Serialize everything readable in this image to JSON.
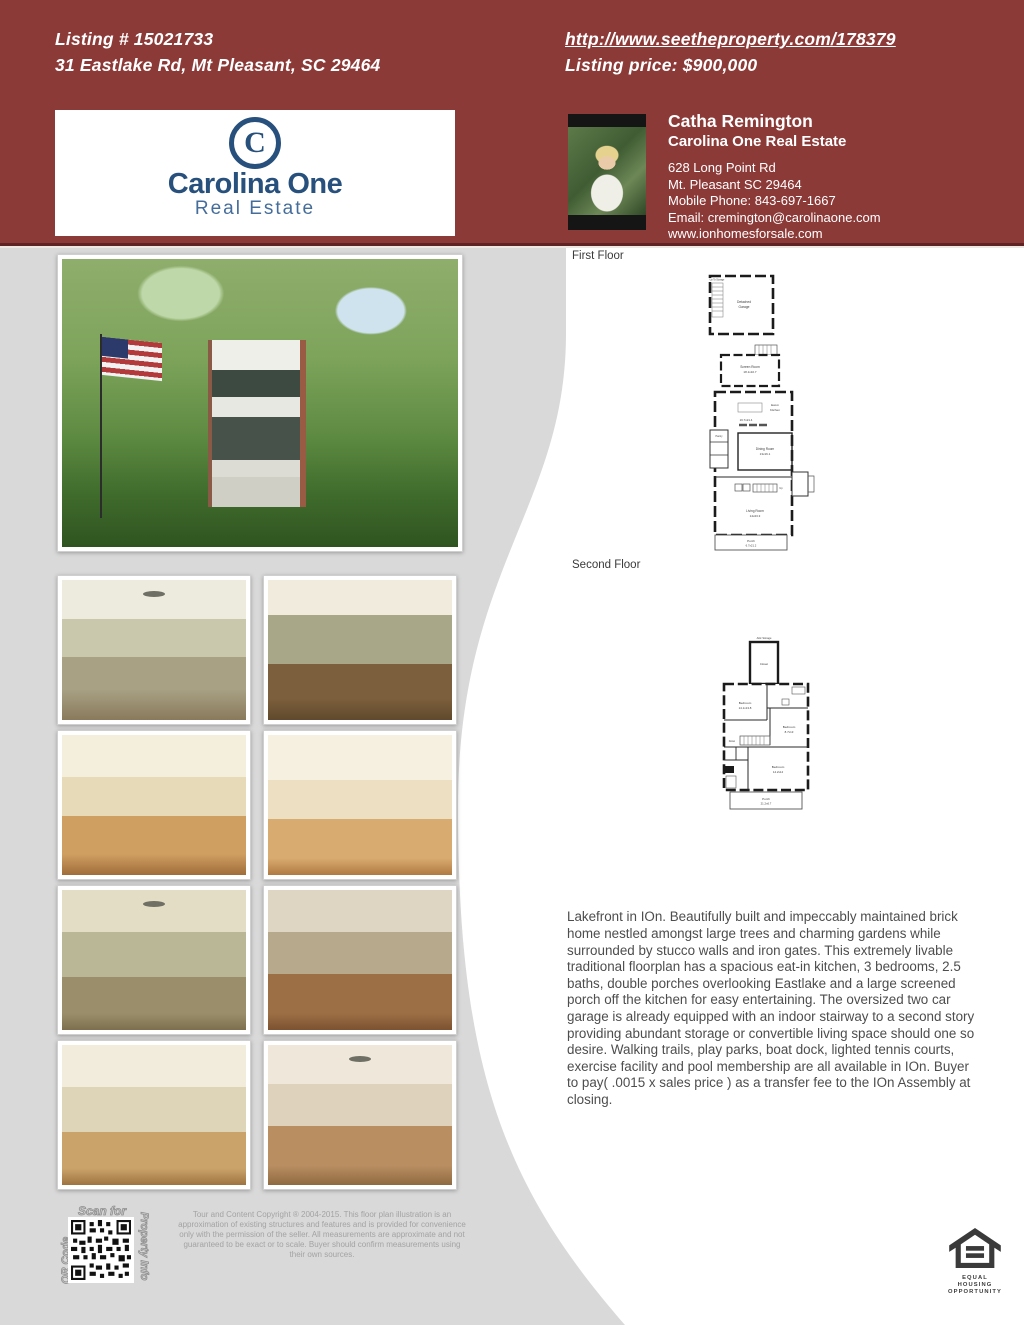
{
  "colors": {
    "maroon_header": "#8c3a38",
    "header_rule": "#5e2423",
    "logo_navy": "#27507c",
    "page_gray": "#d9d9d9",
    "panel_white": "#ffffff",
    "text_gray": "#4d4d4d"
  },
  "header": {
    "listing_number": "Listing # 15021733",
    "address": "31 Eastlake Rd, Mt Pleasant, SC 29464",
    "tour_url": "http://www.seetheproperty.com/178379",
    "price_label": "Listing price: $900,000"
  },
  "brokerage": {
    "monogram": "C",
    "name": "Carolina One",
    "subtitle": "Real Estate"
  },
  "agent": {
    "name": "Catha Remington",
    "company": "Carolina One Real Estate",
    "address_line1": "628 Long Point Rd",
    "address_line2": "Mt. Pleasant SC 29464",
    "phone": "Mobile Phone: 843-697-1667",
    "email": "Email: cremington@carolinaone.com",
    "website": "www.ionhomesforsale.com"
  },
  "photos": {
    "main": "front exterior of brick home with double porches, large trees and American flag",
    "grid": [
      "living room with fireplace and ceiling fan",
      "dining room with floral wallpaper and chandelier",
      "kitchen with wood-top island",
      "kitchen with white cabinets and island",
      "bedroom with ceiling fan and French doors",
      "sitting room with sofa and artwork",
      "home office with bookshelves and lamp",
      "bedroom with four-poster canopy bed"
    ]
  },
  "floorplans": {
    "first_floor": {
      "label": "First Floor",
      "garage": {
        "name_line1": "Detached",
        "name_line2": "Garage",
        "stair_note": "Up To Storage"
      },
      "screen_room": {
        "name": "Screen Room",
        "dim": "18.1x10.7"
      },
      "kitchen": {
        "name_line1": "Eat-in",
        "name_line2": "Kitchen",
        "dim": "16.7x21.4"
      },
      "dining_room": {
        "name": "Dining Room",
        "dim": "13x16.1"
      },
      "pantry": {
        "name": "Pantry"
      },
      "stairs": {
        "name": "Up"
      },
      "living_room": {
        "name": "Living Room",
        "dim": "14x23.3"
      },
      "porch": {
        "name": "Porch",
        "dim": "6.7x21.2"
      }
    },
    "second_floor": {
      "label": "Second Floor",
      "attic": {
        "name": "Attic Storage"
      },
      "closet": {
        "name": "Closet"
      },
      "bedroom1": {
        "name": "Bedroom",
        "dim": "14.1x13.8"
      },
      "bedroom2": {
        "name": "Bedroom",
        "dim": "8.7x13"
      },
      "stairs": {
        "name": "Down"
      },
      "bedroom3": {
        "name": "Bedroom",
        "dim": "14.2x14"
      },
      "porch": {
        "name": "Porch",
        "dim": "21.2x6.7"
      }
    }
  },
  "description": {
    "text": "Lakefront in IOn. Beautifully built and impeccably maintained brick home nestled amongst large trees and charming gardens while surrounded by stucco walls and iron gates. This extremely livable traditional floorplan has a spacious eat-in kitchen, 3 bedrooms, 2.5 baths, double porches overlooking Eastlake and a large screened porch off the kitchen for easy entertaining. The oversized two car garage is already equipped with an indoor stairway to a second story providing abundant storage or convertible living space should one so desire. Walking trails, play parks, boat dock, lighted tennis courts, exercise facility and pool membership are all available in IOn. Buyer to pay( .0015 x sales price ) as a transfer fee to the IOn Assembly at closing."
  },
  "qr": {
    "scan_for": "Scan for",
    "left_label": "QR Code",
    "right_label": "Property Info"
  },
  "footer": {
    "copyright": "Tour and Content Copyright ® 2004-2015. This floor plan illustration is an approximation of existing structures and features and is provided for convenience only with the permission of the seller. All measurements are approximate and not guaranteed to be exact or to scale. Buyer should confirm measurements using their own sources.",
    "equal_housing_line1": "EQUAL HOUSING",
    "equal_housing_line2": "OPPORTUNITY"
  }
}
